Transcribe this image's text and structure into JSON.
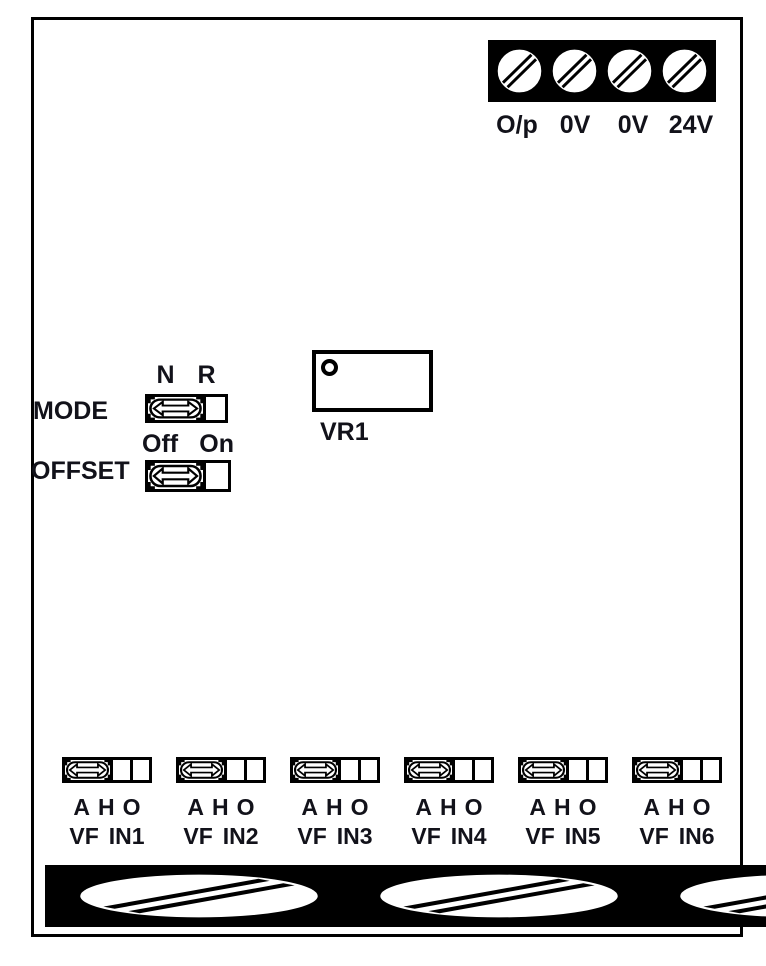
{
  "power_terminals": {
    "labels": [
      "O/p",
      "0V",
      "0V",
      "24V"
    ]
  },
  "mode_switch": {
    "label": "MODE",
    "position_labels": [
      "N",
      "R"
    ]
  },
  "offset_switch": {
    "label": "OFFSET",
    "position_labels": [
      "Off",
      "On"
    ]
  },
  "potentiometer": {
    "label": "VR1"
  },
  "channels": [
    {
      "position_labels": [
        "A",
        "H",
        "O"
      ],
      "terminal_labels": [
        "VF",
        "IN1"
      ]
    },
    {
      "position_labels": [
        "A",
        "H",
        "O"
      ],
      "terminal_labels": [
        "VF",
        "IN2"
      ]
    },
    {
      "position_labels": [
        "A",
        "H",
        "O"
      ],
      "terminal_labels": [
        "VF",
        "IN3"
      ]
    },
    {
      "position_labels": [
        "A",
        "H",
        "O"
      ],
      "terminal_labels": [
        "VF",
        "IN4"
      ]
    },
    {
      "position_labels": [
        "A",
        "H",
        "O"
      ],
      "terminal_labels": [
        "VF",
        "IN5"
      ]
    },
    {
      "position_labels": [
        "A",
        "H",
        "O"
      ],
      "terminal_labels": [
        "VF",
        "IN6"
      ]
    }
  ],
  "colors": {
    "line": "#000000",
    "text": "#12121a",
    "background": "#ffffff"
  }
}
